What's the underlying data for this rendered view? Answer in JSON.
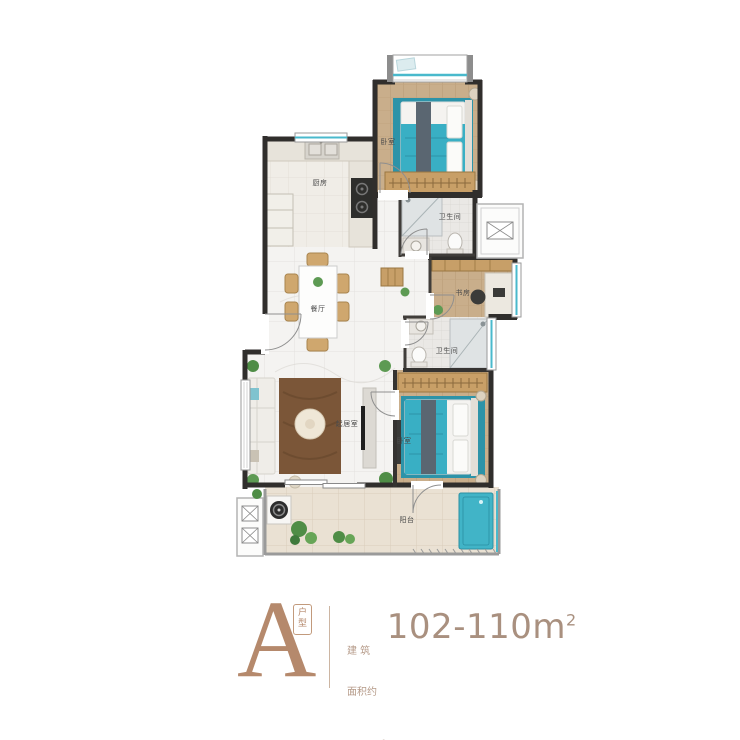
{
  "plan": {
    "rooms": [
      {
        "id": "bedroom-top",
        "label": "卧室"
      },
      {
        "id": "kitchen",
        "label": "厨房"
      },
      {
        "id": "dining",
        "label": "餐厅"
      },
      {
        "id": "bath-top",
        "label": "卫生间"
      },
      {
        "id": "study",
        "label": "书房"
      },
      {
        "id": "bath-bottom",
        "label": "卫生间"
      },
      {
        "id": "living",
        "label": "起居室"
      },
      {
        "id": "bedroom-bottom",
        "label": "卧室"
      },
      {
        "id": "balcony",
        "label": "阳台"
      }
    ]
  },
  "info": {
    "type_letter": "A",
    "type_badge": "户型",
    "area_prefix_line1": "建 筑",
    "area_prefix_line2": "面积约",
    "area_value": "102-110m",
    "area_sup": "2",
    "layout_text": "三室两厅两卫"
  },
  "colors": {
    "accent_bronze": "#b5896c",
    "text_tan": "#b49a89",
    "wall_dark": "#302e2c",
    "window_teal": "#49b9cc",
    "bed_teal": "#39afc4",
    "wood": "#c9ae8b",
    "rug_brown": "#7b5638"
  }
}
